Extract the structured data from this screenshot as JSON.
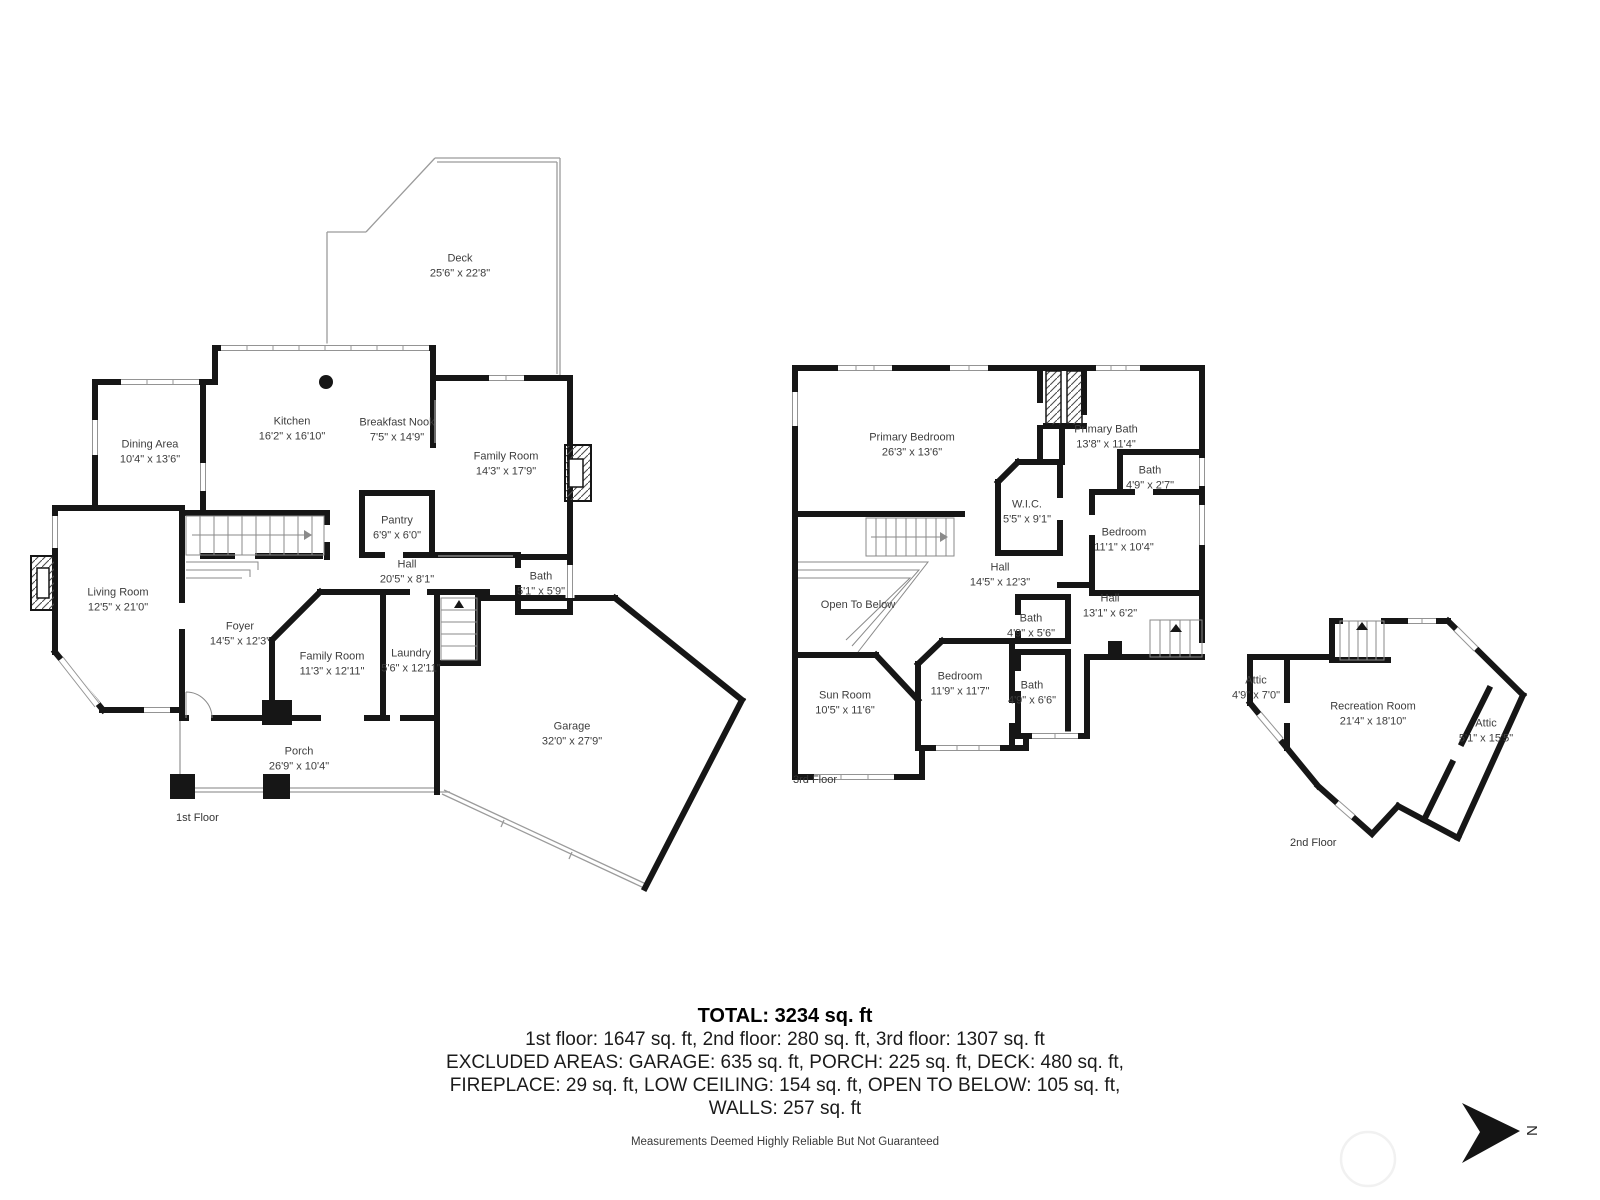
{
  "palette": {
    "wall": "#161616",
    "thin_line": "#9b9b9b",
    "label_text": "#3d3d3d"
  },
  "compass": {
    "label": "N"
  },
  "summary": {
    "total": "TOTAL: 3234 sq. ft",
    "floors_line": "1st floor: 1647 sq. ft, 2nd floor: 280 sq. ft, 3rd floor: 1307 sq. ft",
    "excluded_line_1": "EXCLUDED AREAS: GARAGE: 635 sq. ft, PORCH: 225 sq. ft, DECK: 480 sq. ft,",
    "excluded_line_2": "FIREPLACE: 29 sq. ft, LOW CEILING: 154 sq. ft, OPEN TO BELOW: 105 sq. ft,",
    "excluded_line_3": "WALLS: 257 sq. ft"
  },
  "footer": {
    "disclaimer": "Measurements Deemed Highly Reliable But Not Guaranteed"
  },
  "floors": [
    {
      "caption": "1st Floor",
      "rooms": [
        {
          "name": "Deck",
          "dims": "25'6\" x 22'8\""
        },
        {
          "name": "Dining Area",
          "dims": "10'4\" x 13'6\""
        },
        {
          "name": "Kitchen",
          "dims": "16'2\" x 16'10\""
        },
        {
          "name": "Breakfast Nook",
          "dims": "7'5\" x 14'9\""
        },
        {
          "name": "Family Room",
          "dims": "14'3\" x 17'9\""
        },
        {
          "name": "Pantry",
          "dims": "6'9\" x 6'0\""
        },
        {
          "name": "Hall",
          "dims": "20'5\" x 8'1\""
        },
        {
          "name": "Bath",
          "dims": "5'1\" x 5'9\""
        },
        {
          "name": "Living Room",
          "dims": "12'5\" x 21'0\""
        },
        {
          "name": "Foyer",
          "dims": "14'5\" x 12'3\""
        },
        {
          "name": "Family Room",
          "dims": "11'3\" x 12'11\""
        },
        {
          "name": "Laundry",
          "dims": "5'6\" x 12'11\""
        },
        {
          "name": "Porch",
          "dims": "26'9\" x 10'4\""
        },
        {
          "name": "Garage",
          "dims": "32'0\" x 27'9\""
        }
      ]
    },
    {
      "caption": "3rd Floor",
      "rooms": [
        {
          "name": "Primary Bedroom",
          "dims": "26'3\" x 13'6\""
        },
        {
          "name": "Primary Bath",
          "dims": "13'8\" x 11'4\""
        },
        {
          "name": "Bath",
          "dims": "4'9\" x 2'7\""
        },
        {
          "name": "W.I.C.",
          "dims": "5'5\" x 9'1\""
        },
        {
          "name": "Bedroom",
          "dims": "11'1\" x 10'4\""
        },
        {
          "name": "Hall",
          "dims": "14'5\" x 12'3\""
        },
        {
          "name": "Open To Below",
          "dims": ""
        },
        {
          "name": "Hall",
          "dims": "13'1\" x 6'2\""
        },
        {
          "name": "Bath",
          "dims": "4'9\" x 5'6\""
        },
        {
          "name": "Bedroom",
          "dims": "11'9\" x 11'7\""
        },
        {
          "name": "Bath",
          "dims": "4'9\" x 6'6\""
        },
        {
          "name": "Sun Room",
          "dims": "10'5\" x 11'6\""
        }
      ]
    },
    {
      "caption": "2nd Floor",
      "rooms": [
        {
          "name": "Attic",
          "dims": "4'9\" x 7'0\""
        },
        {
          "name": "Recreation Room",
          "dims": "21'4\" x 18'10\""
        },
        {
          "name": "Attic",
          "dims": "5'1\" x 15'5\""
        }
      ]
    }
  ]
}
